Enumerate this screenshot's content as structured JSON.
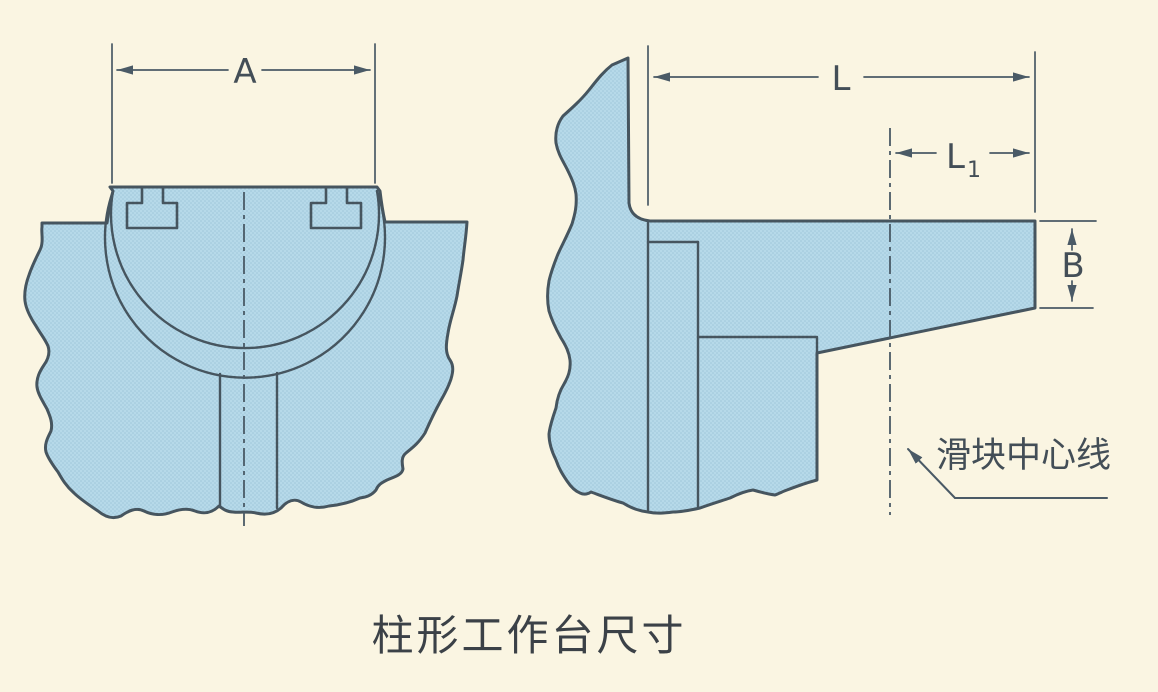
{
  "figure": {
    "caption": "柱形工作台尺寸",
    "annotation": "滑块中心线",
    "labels": {
      "a": "A",
      "l": "L",
      "l1_main": "L",
      "l1_sub": "1",
      "b": "B"
    },
    "colors": {
      "background": "#faf5e2",
      "part_fill": "#b6d9e9",
      "halftone_dot": "#9dc6d9",
      "outline": "#46555f",
      "dimension": "#4a5a66",
      "label_text": "#434e57",
      "caption_text": "#3b4147"
    }
  }
}
